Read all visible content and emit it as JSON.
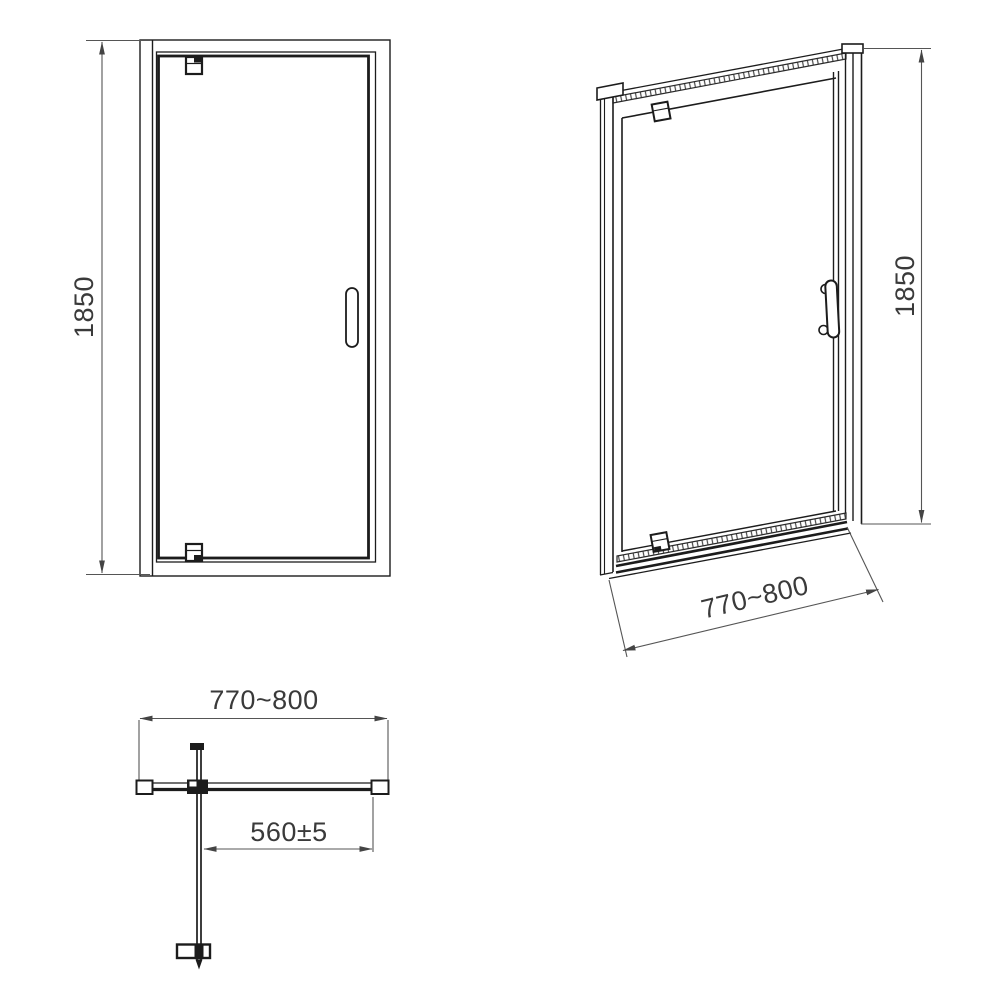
{
  "drawing": {
    "front_view": {
      "height_label": "1850"
    },
    "perspective_view": {
      "height_label": "1850",
      "width_label": "770~800"
    },
    "plan_view": {
      "width_label": "770~800",
      "opening_label": "560±5"
    }
  },
  "colors": {
    "background": "#ffffff",
    "object_line": "#1c1c1c",
    "dimension_line": "#555555",
    "text": "#3a3a3a"
  }
}
